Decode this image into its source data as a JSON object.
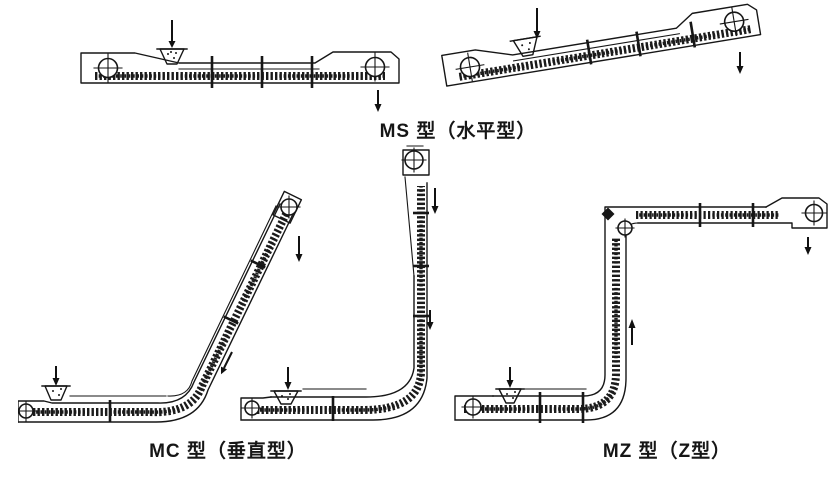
{
  "canvas": {
    "background": "#ffffff",
    "ink": "#161616"
  },
  "captions": {
    "ms": "MS 型（水平型）",
    "mc": "MC 型（垂直型）",
    "mz": "MZ 型（Z型）"
  }
}
